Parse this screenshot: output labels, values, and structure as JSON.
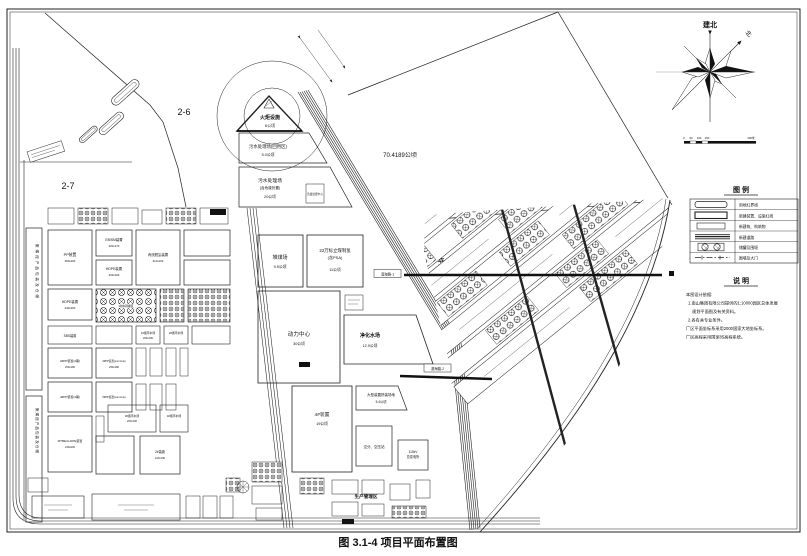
{
  "figure": {
    "title": "图 3.1-4  项目平面布置图"
  },
  "compass": {
    "construction_north": "建北",
    "north": "北",
    "scale": [
      "0",
      "50",
      "100",
      "150",
      "300米"
    ]
  },
  "legend": {
    "title": "图  例",
    "items": [
      {
        "symbol": "site-boundary-rect",
        "label": "用地红界线"
      },
      {
        "symbol": "new-unit-redline-rect",
        "label": "新建装置、设施红线"
      },
      {
        "symbol": "new-building-rect",
        "label": "新建筑、构筑物"
      },
      {
        "symbol": "new-road-lines",
        "label": "新建道路"
      },
      {
        "symbol": "tank-and-dike-circles",
        "label": "储罐及围堰"
      },
      {
        "symbol": "wall-and-gate-line",
        "label": "围墙及大门"
      }
    ]
  },
  "notes": {
    "title": "说  明",
    "lines": [
      "本图设计依据:",
      "1.南山集团有限公司提供的1:10000园区总体发展",
      "规划平面图及有关资料。",
      "2.各有关专业条件。",
      "厂区平面坐标系采用2000国家大地坐标系。",
      "厂区高程采用国家85高程系统。"
    ]
  },
  "parcels": {
    "p26": "2-6",
    "p27": "2-7",
    "flare": "火炬设施",
    "flare_area": "6公顷",
    "ww_reuse": "污水处理场(回用区)",
    "ww_reuse_area": "5.0公顷",
    "ww": "污水处理场",
    "ww_sub": "(含危废处置)",
    "ww_area": "20公顷",
    "haz_center": "危废处置中心",
    "wharf_area": "70.4189公顷",
    "wharf": "3#码头",
    "coal_yard": "堆煤场",
    "coal_yard_area": "9.5公顷",
    "coal_h2": "22万标立煤制氢",
    "coal_h2_sub": "(含PSA)",
    "coal_h2_area": "11公顷",
    "power": "动力中心",
    "power_area": "30公顷",
    "water": "净化水场",
    "water_area": "12.9公顷",
    "unit4": "4#装置",
    "unit4_area": "19公顷",
    "assembly": "大型装置拼装场地",
    "assembly_area": "5.4公顷",
    "air_station": "空分、空压站",
    "substation1": "110kV",
    "substation2": "总变电所",
    "mgmt": "生产管理区",
    "road1": "滨海路-1",
    "road2": "滨海路-2"
  },
  "units": {
    "pack": "聚烯烃产品包装及仓储",
    "pp": "PP装置",
    "pp_d": "360x200",
    "ebsm": "EB/SM装置",
    "ebsm_d": "200x170",
    "hdpe": "HDPE装置",
    "hdpe_d": "200x160",
    "pdh": "丙烷脱氢装置",
    "pdh_d": "310x160",
    "hdpe2": "HDPE装置",
    "hdpe2_d": "240x200",
    "midtank": "1#中间罐区",
    "sbs": "SBS装置",
    "cw1": "1#循环水场",
    "cw2": "2#循环水场",
    "cw3": "3#循环水场",
    "cw4": "4#循环水场",
    "cw_d": "200x100",
    "pp2": "2#PP装置(2期)",
    "pp2_d": "250x180",
    "pp3": "3#PP装置(Lummus)",
    "pp3_d": "250x180",
    "pp4": "4#PP装置(2期)",
    "pp5": "5#PP装置(Lummus)",
    "mtbe": "MTBE/LLDPE装置",
    "mtbe_d": "240x200",
    "unit2": "2#装置",
    "unit2_d": "220x190"
  }
}
